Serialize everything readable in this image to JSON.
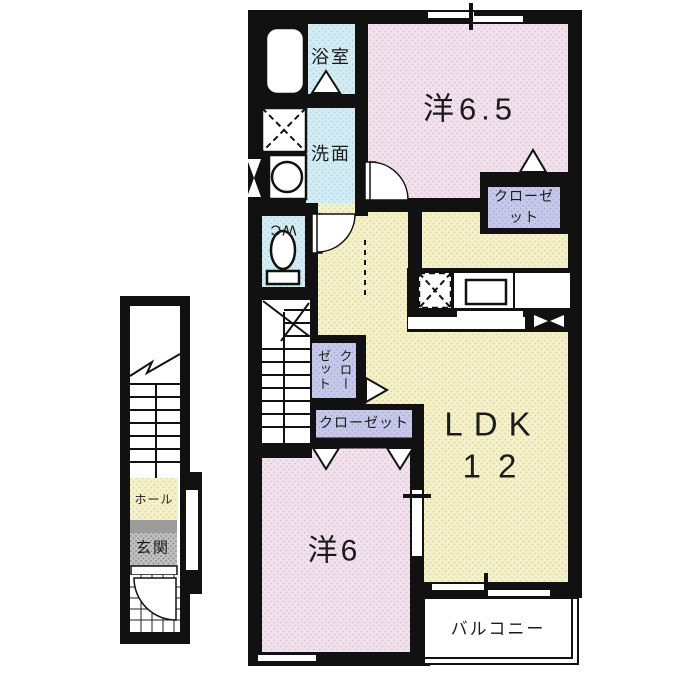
{
  "rooms": {
    "bathroom": "浴室",
    "washroom": "洗面",
    "wc": "WC",
    "western_65": "洋6.5",
    "closet_65": "クローゼット",
    "closet_mid": "クローゼット",
    "closet_lower": "クローゼット",
    "ldk": "LDK",
    "ldk_size": "12",
    "western_6": "洋6",
    "balcony": "バルコニー",
    "hall": "ホール",
    "entrance": "玄関"
  },
  "colors": {
    "wall": "#111111",
    "room_pink": "#f1e1ec",
    "room_yellow": "#f4f1ca",
    "room_blue": "#d3ebf3",
    "closet_purple": "#c7c8e9",
    "entrance_gray": "#c0c0c0",
    "step_gray": "#9c9c9c",
    "text": "#1b1b1b"
  }
}
